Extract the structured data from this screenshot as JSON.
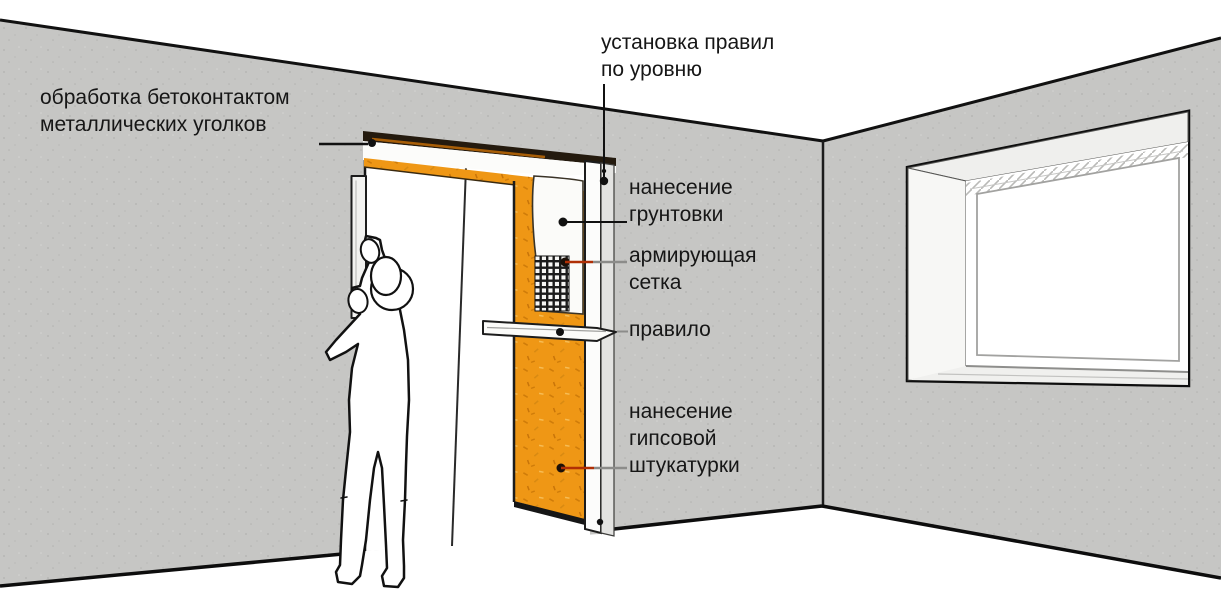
{
  "labels": {
    "corner_treatment": {
      "line1": "обработка бетоконтактом",
      "line2": "металлических уголков"
    },
    "rules_by_level": {
      "line1": "установка правил",
      "line2": "по уровню"
    },
    "primer": {
      "line1": "нанесение",
      "line2": "грунтовки"
    },
    "mesh": {
      "line1": "армирующая",
      "line2": "сетка"
    },
    "rule_tool": {
      "line1": "правило"
    },
    "gypsum_plaster": {
      "line1": "нанесение",
      "line2": "гипсовой",
      "line3": "штукатурки"
    }
  },
  "colors": {
    "wall_gray": "#c6c6c4",
    "plaster_orange": "#ef9715",
    "leader_red": "#b02f05",
    "leader_gray": "#8c8c8a",
    "line_black": "#161616",
    "reveal_white": "#f4f4f2"
  }
}
